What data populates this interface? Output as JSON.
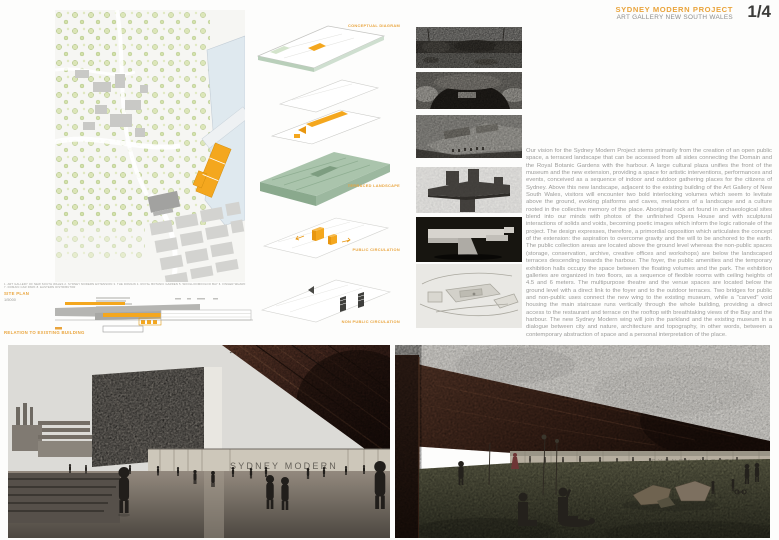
{
  "header": {
    "title": "SYDNEY MODERN PROJECT",
    "subtitle": "ART GALLERY NEW SOUTH WALES",
    "page_number": "1/4"
  },
  "site_plan": {
    "legend_line": "1. ART GALLERY OF NEW SOUTH WALES   2. SYDNEY MODERN EXTENSION   3. THE DOMAIN   4. ROYAL BOTANIC GARDEN   5. WOOLLOOMOOLOO BAY   6. FINGER WHARF   7. DOMAIN CAR PARK   8. EASTERN DISTRIBUTOR",
    "label": "SITE PLAN",
    "scale": "1/5000",
    "relation_label": "RELATION TO EXISTING BUILDING"
  },
  "diagrams": {
    "labels": [
      "CONCEPTUAL DIAGRAM",
      "TERRACED LANDSCAPE",
      "PUBLIC CIRCULATION",
      "NON PUBLIC CIRCULATION"
    ]
  },
  "description": {
    "paragraph": "Our vision for the Sydney Modern Project stems primarily from the creation of an open public space, a terraced landscape that can be accessed from all sides connecting the Domain and the Royal Botanic Gardens with the harbour. A large cultural plaza unifies the front of the museum and the new extension, providing a space for artistic interventions, performances and events, conceived as a sequence of indoor and outdoor gathering places for the citizens of Sydney. Above this new landscape, adjacent to the existing building of the Art Gallery of New South Wales, visitors will encounter two bold interlocking volumes which seem to levitate above the ground, evoking platforms and caves, metaphors of a landscape and a culture rooted in the collective memory of the place. Aboriginal rock art found in archaeological sites blend into our minds with photos of the unfinished Opera House and with sculptural interactions of solids and voids, becoming poetic images which inform the logic rationale of the project. The design expresses, therefore, a primordial opposition which articulates the concept of the extension: the aspiration to overcome gravity and the will to be anchored to the earth. The public collection areas are located above the ground level whereas the non-public spaces (storage, conservation, archive, creative offices and workshops) are below the landscaped terraces descending towards the harbour. The foyer, the public amenities and the temporary exhibition halls occupy the space between the floating volumes and the park. The exhibition galleries are organized in two floors, as a sequence of flexible rooms with ceiling heights of 4.5 and 6 meters. The multipurpose theatre and the venue spaces are located below the ground level with a direct link to the foyer and to the outdoor terraces. Two bridges for public and non-public uses connect the new wing to the existing museum, while a \"carved\" void housing the main staircase runs vertically through the whole building, providing a direct access to the restaurant and terrace on the rooftop with breathtaking views of the Bay and the harbour. The new Sydney Modern wing will join the parkland and the existing museum in a dialogue between city and nature, architecture and topography, in other words, between a contemporary abstraction of space and a personal interpretation of the place."
  },
  "renders": {
    "left_signage": "SYDNEY MODERN",
    "right_signage": "SYDNEY MODERN"
  },
  "colors": {
    "accent_orange": "#E9A43C",
    "project_orange": "#F4A71E",
    "diagram_green": "#AAC4AC",
    "body_text_gray": "#9B9B99",
    "map_water_blue": "#DFE9EF"
  }
}
